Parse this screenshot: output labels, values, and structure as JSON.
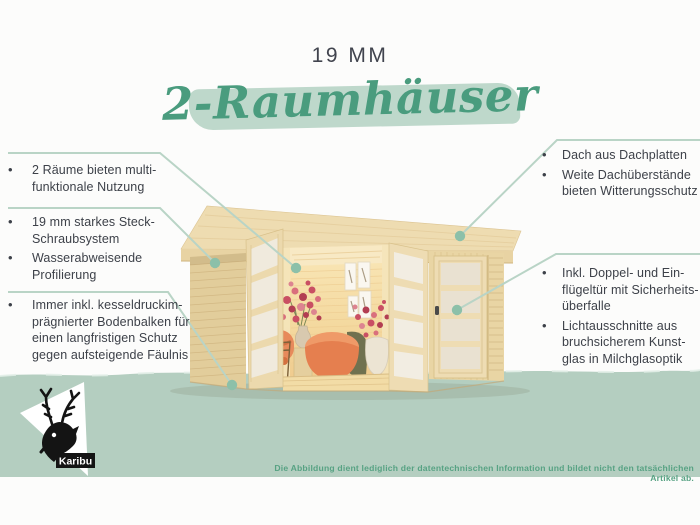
{
  "header": {
    "size_label": "19 MM",
    "title": "2-Raumhäuser"
  },
  "features": {
    "left": [
      {
        "bullets": [
          "2 Räume bieten multi-\nfunktionale Nutzung"
        ]
      },
      {
        "bullets": [
          "19 mm starkes Steck-\nSchraubsystem",
          "Wasserabweisende\nProfilierung"
        ]
      },
      {
        "bullets": [
          "Immer inkl. kesseldruckim-\nprägnierter Bodenbalken für\neinen langfristigen Schutz\ngegen aufsteigende Fäulnis"
        ]
      }
    ],
    "right": [
      {
        "bullets": [
          "Dach aus Dachplatten",
          "Weite Dachüberstände\nbieten Witterungsschutz"
        ]
      },
      {
        "bullets": [
          "Inkl. Doppel- und Ein-\nflügeltür mit Sicherheits-\nüberfalle",
          "Lichtausschnitte aus\nbruchsicherem Kunst-\nglas in Milchglasoptik"
        ]
      }
    ]
  },
  "logo": {
    "brand": "Karibu"
  },
  "footer": {
    "disclaimer": "Die Abbildung dient lediglich der datentechnischen Information und bildet nicht den tatsächlichen Artikel ab."
  },
  "colors": {
    "accent_green": "#4a9c7e",
    "brush_stroke": "#bed8cb",
    "band": "#b4cec0",
    "connector_line": "#b9d4c6",
    "connector_dot": "#8cc0a9",
    "body_text": "#3d4149",
    "disclaimer_text": "#57a283"
  }
}
